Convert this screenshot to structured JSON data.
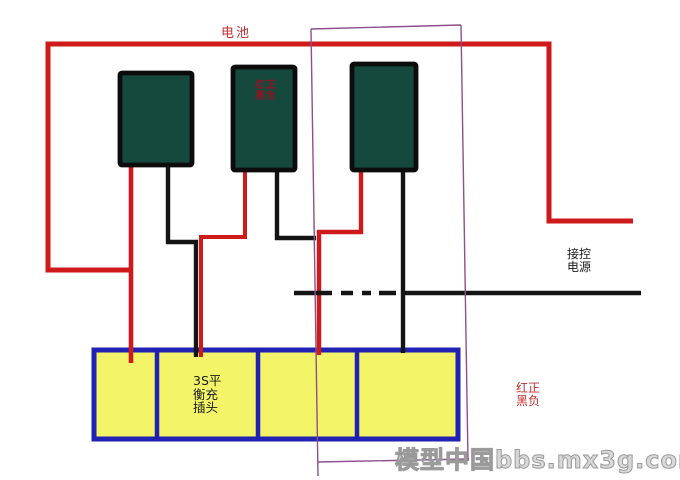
{
  "labels": {
    "battery_group": "电池",
    "battery2_marking": "红正\n黑负",
    "control_power": "接控\n电源",
    "balance_plug": "3S平\n衡充\n插头",
    "wire_legend": "红正\n黑负"
  },
  "watermark": "模型中国bbs.mx3g.com",
  "colors": {
    "wire_red": "#ce1a1a",
    "wire_black": "#141414",
    "plug_border_blue": "#2121b4",
    "plug_fill_yellow": "#f4f468",
    "battery_fill": "#16493e",
    "battery_border": "#0c0c0c",
    "overlay_purple": "#8d4f8d",
    "label_red": "#c03030",
    "marking_red": "#8d1622",
    "label_black": "#1a1a1a",
    "watermark_gray": "#9a9a9a",
    "watermark_fill": "#d8d8d8"
  },
  "diagram": {
    "battery_count": 3,
    "plug_pin_count": 4
  }
}
